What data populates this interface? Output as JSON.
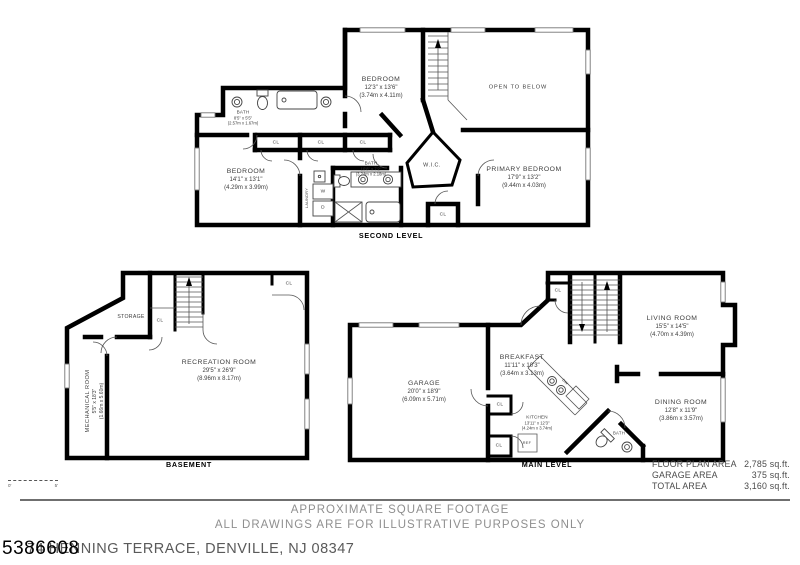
{
  "second_level": {
    "caption": "SECOND LEVEL",
    "rooms": {
      "bedroom_top": {
        "name": "BEDROOM",
        "imperial": "12'3\" x 13'6\"",
        "metric": "(3.74m x 4.11m)"
      },
      "open_to_below": {
        "name": "OPEN TO BELOW"
      },
      "bath_top": {
        "name": "BATH",
        "imperial": "8'5\" x 5'5\"",
        "metric": "(2.57m x 1.67m)"
      },
      "bedroom_left": {
        "name": "BEDROOM",
        "imperial": "14'1\" x 13'1\"",
        "metric": "(4.29m x 3.99m)"
      },
      "wic": {
        "name": "W.I.C."
      },
      "primary_bedroom": {
        "name": "PRIMARY BEDROOM",
        "imperial": "17'9\" x 13'2\"",
        "metric": "(9.44m x 4.03m)"
      },
      "bath_bottom": {
        "name": "BATH",
        "imperial": "10'8\" x 7'2\"",
        "metric": "(3.24m x 2.18m)"
      },
      "laundry": {
        "name": "LAUNDRY"
      }
    }
  },
  "basement": {
    "caption": "BASEMENT",
    "rooms": {
      "storage": {
        "name": "STORAGE"
      },
      "recreation": {
        "name": "RECREATION ROOM",
        "imperial": "29'5\" x 26'9\"",
        "metric": "(8.96m x 8.17m)"
      },
      "mechanical": {
        "name": "MECHANICAL ROOM",
        "imperial": "5'5\" x 18'3\"",
        "metric": "(1.66m x 5.60m)"
      }
    }
  },
  "main_level": {
    "caption": "MAIN LEVEL",
    "rooms": {
      "garage": {
        "name": "GARAGE",
        "imperial": "20'0\" x 18'9\"",
        "metric": "(6.09m x 5.71m)"
      },
      "breakfast": {
        "name": "BREAKFAST",
        "imperial": "11'11\" x 10'3\"",
        "metric": "(3.64m x 3.13m)"
      },
      "kitchen": {
        "name": "KITCHEN",
        "imperial": "13'11\" x 12'3\"",
        "metric": "(4.24m x 3.74m)"
      },
      "living": {
        "name": "LIVING ROOM",
        "imperial": "15'5\" x 14'5\"",
        "metric": "(4.70m x 4.39m)"
      },
      "dining": {
        "name": "DINING ROOM",
        "imperial": "12'8\" x 11'9\"",
        "metric": "(3.86m x 3.57m)"
      },
      "bath": {
        "name": "BATH"
      }
    }
  },
  "glyphs": {
    "closet": "CL",
    "washer": "W",
    "dryer": "D",
    "fridge": "REF",
    "dishwasher": "DW"
  },
  "area_table": {
    "rows": [
      {
        "label": "FLOOR PLAN AREA",
        "value": "2,785 sq.ft."
      },
      {
        "label": "GARAGE AREA",
        "value": "375 sq.ft."
      },
      {
        "label": "TOTAL AREA",
        "value": "3,160 sq.ft."
      }
    ]
  },
  "scale_bar": {
    "start": "0'",
    "end": "5'"
  },
  "footer": {
    "line1": "APPROXIMATE SQUARE FOOTAGE",
    "line2": "ALL DRAWINGS ARE FOR ILLUSTRATIVE PURPOSES ONLY",
    "address": "74 HENNING TERRACE, DENVILLE, NJ 08347",
    "listing_number": "5386608"
  }
}
